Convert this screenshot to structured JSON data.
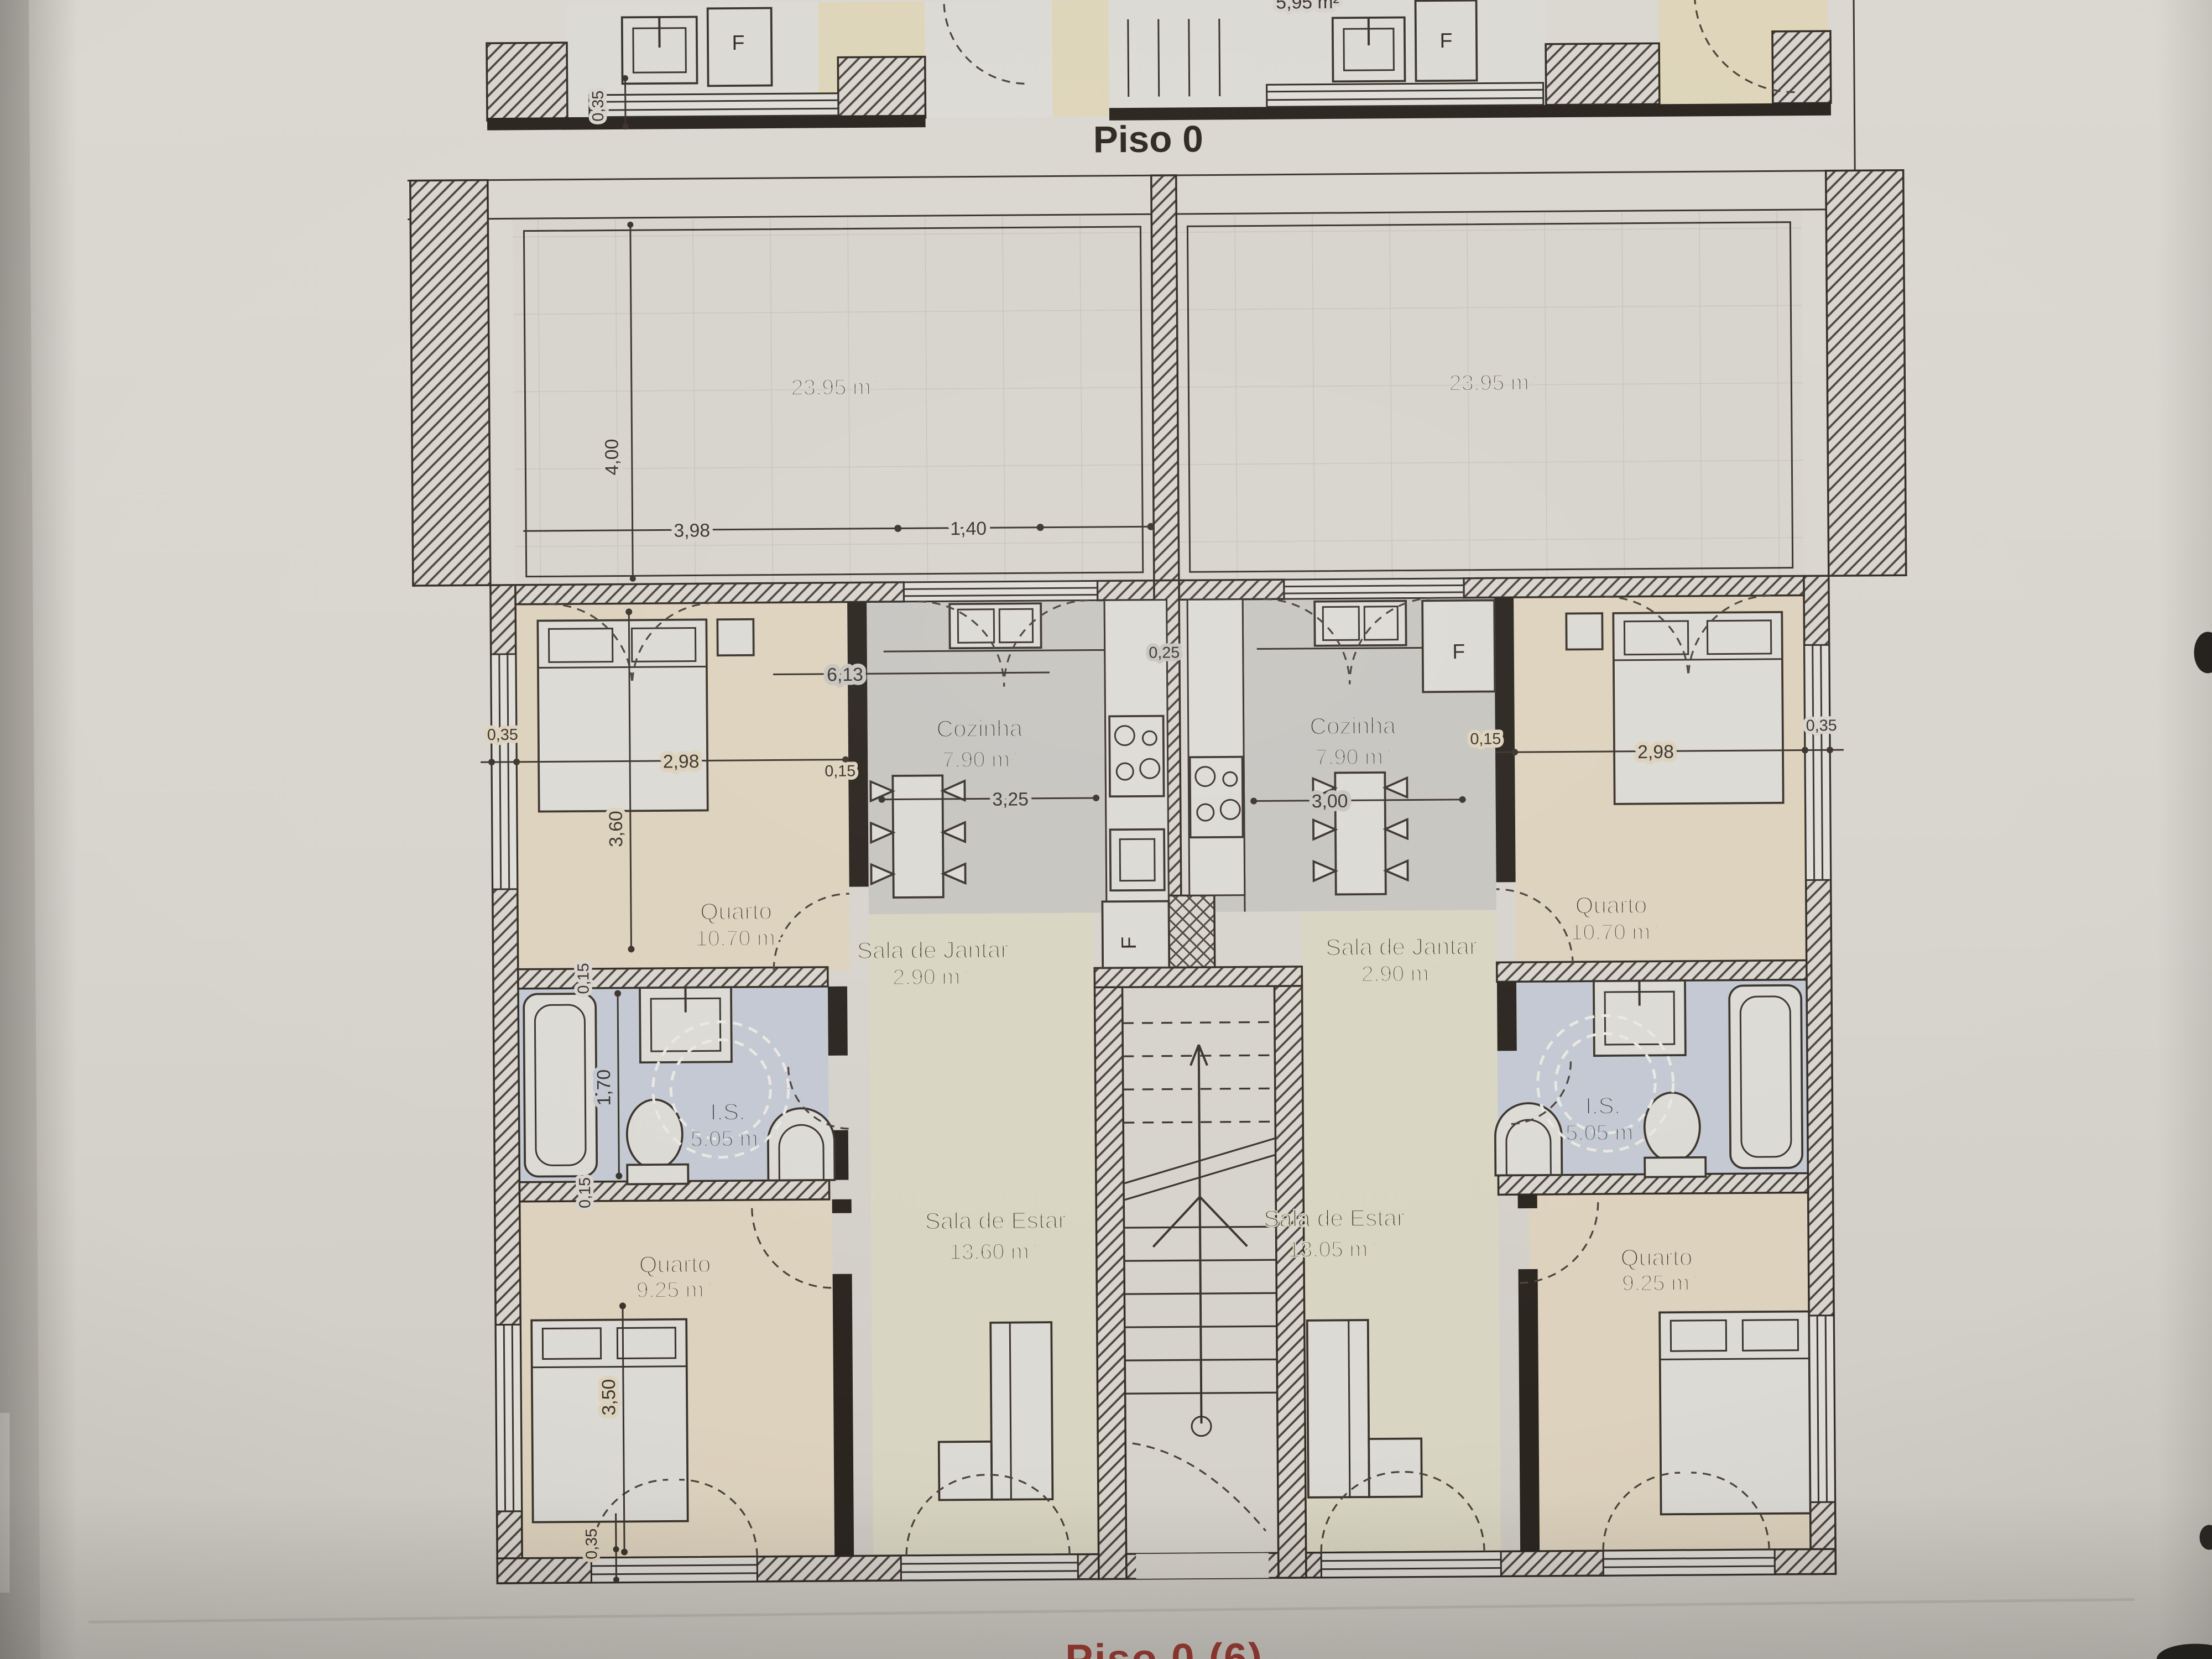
{
  "document": {
    "title": "Piso 0",
    "footer_title": "Piso 0 (6)"
  },
  "upper_strip": {
    "left_fridge_label": "F",
    "right_fridge_label": "F",
    "wall_dim": "0,35",
    "partial_area_label": "5,95 m²"
  },
  "terrace_left": {
    "area": "23,95 m²",
    "depth_dim": "4,00",
    "width_dim": "3,98",
    "offset_dim": "1,40"
  },
  "terrace_right": {
    "area": "23,95 m²"
  },
  "apartment_left": {
    "bedroom1_name": "Quarto",
    "bedroom1_area": "10,70 m²",
    "kitchen_name": "Cozinha",
    "kitchen_area": "7,90 m²",
    "dining_name": "Sala de Jantar",
    "dining_area": "2,90 m²",
    "bathroom_name": "I.S.",
    "bathroom_area": "5,05 m²",
    "living_name": "Sala de Estar",
    "living_area": "13,60 m²",
    "bedroom2_name": "Quarto",
    "bedroom2_area": "9,25 m²",
    "fridge_label": "F",
    "dim_wall_left": "0,35",
    "dim_bedroom_width": "2,98",
    "dim_wall_interior": "0,15",
    "dim_kitchen_width": "3,25",
    "dim_total_width": "6,13",
    "dim_wall_center": "0,25",
    "dim_bedroom_depth": "3,60",
    "dim_bath_width": "1,70",
    "dim_bath_wall_top": "0,15",
    "dim_bath_wall_bottom": "0,15",
    "dim_bedroom2_depth": "3,50",
    "dim_wall_bottom": "0,35"
  },
  "apartment_right": {
    "bedroom1_name": "Quarto",
    "bedroom1_area": "10,70 m²",
    "kitchen_name": "Cozinha",
    "kitchen_area": "7,90 m²",
    "dining_name": "Sala de Jantar",
    "dining_area": "2,90 m²",
    "bathroom_name": "I.S.",
    "bathroom_area": "5,05 m²",
    "living_name": "Sala de Estar",
    "living_area": "13,05 m²",
    "bedroom2_name": "Quarto",
    "bedroom2_area": "9,25 m²",
    "fridge_label": "F",
    "dim_wall_interior": "0,15",
    "dim_kitchen_width": "3,00",
    "dim_bedroom_width": "2,98",
    "dim_wall_right": "0,35"
  },
  "colors": {
    "paper": "#d7d4cd",
    "ink": "#332d26",
    "dimension_ink": "#3a342c",
    "bedroom_floor": "#ddd2bd",
    "living_floor": "#d8d5c2",
    "kitchen_floor": "#c7c5c0",
    "bathroom_floor": "#c3c8d2",
    "terrace_floor": "#d7d4cd",
    "footer_red": "#9c3a33"
  }
}
